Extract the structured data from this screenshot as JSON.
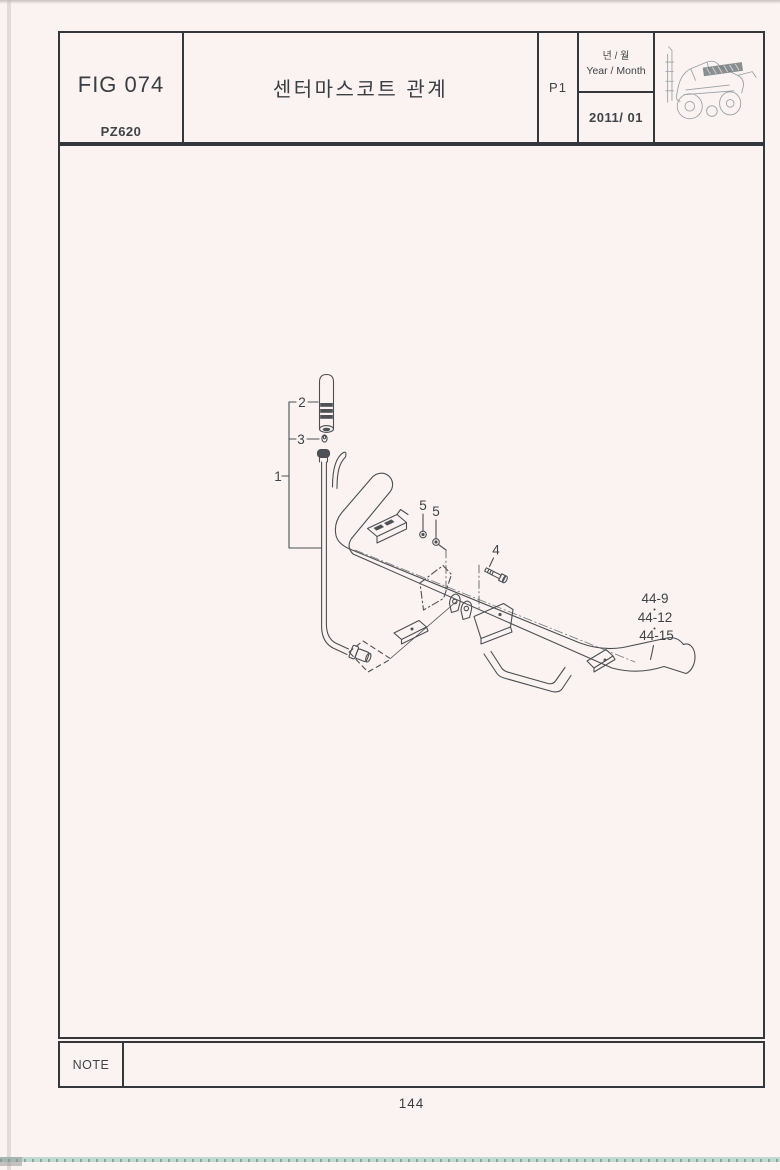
{
  "header": {
    "fig_label": "FIG 074",
    "model_code": "PZ620",
    "title": "센터마스코트 관계",
    "page_ref": "P1",
    "year_month_ko": "년 / 월",
    "year_month_en": "Year / Month",
    "year_month_value": "2011/ 01",
    "machine_icon": "transplanter-sketch-icon"
  },
  "diagram": {
    "callouts": {
      "c1": "1",
      "c2": "2",
      "c3": "3",
      "c4": "4",
      "c5a": "5",
      "c5b": "5"
    },
    "ref_labels": {
      "r1": "44-9",
      "r2": "44-12",
      "r3": "44-15"
    }
  },
  "footer": {
    "note_label": "NOTE",
    "page_number": "144"
  },
  "colors": {
    "paper": "#fbf3f1",
    "ink": "#4b4f53",
    "border": "#34383c",
    "artifact_teal": "#b2d4ca"
  }
}
